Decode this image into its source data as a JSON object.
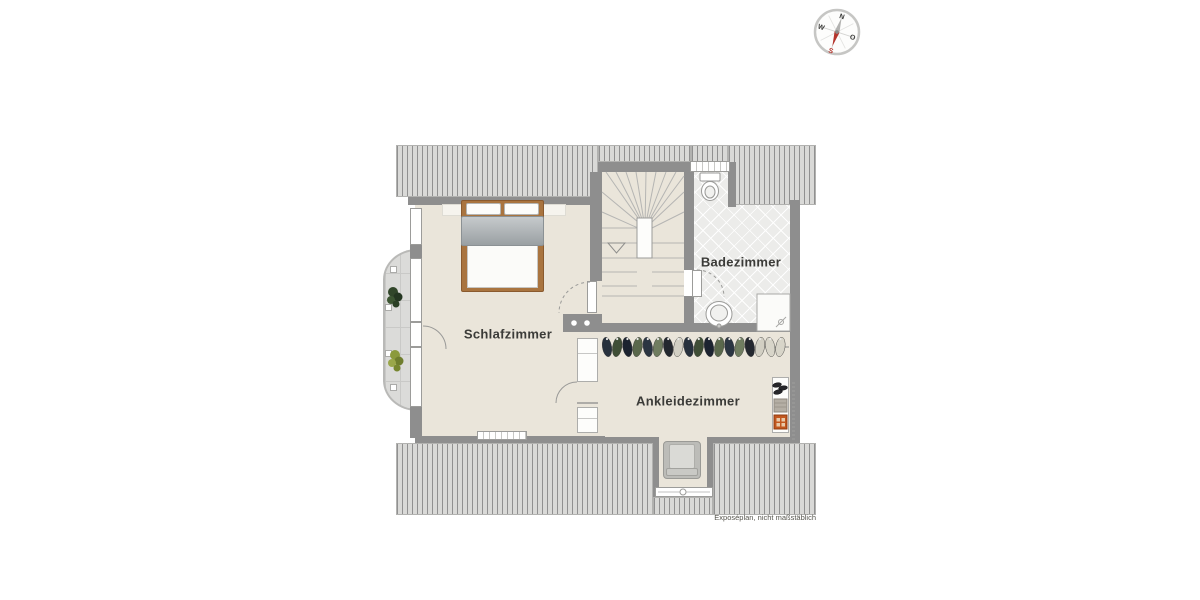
{
  "rooms": {
    "bedroom": "Schlafzimmer",
    "bathroom": "Badezimmer",
    "dressing": "Ankleidezimmer"
  },
  "caption": "Exposéplan, nicht maßstäblich",
  "compass": {
    "north": "N",
    "east": "O",
    "south": "S",
    "west": "W"
  },
  "colors": {
    "floor": "#eae5da",
    "wall": "#8e8e8e",
    "hatch_bg": "#d9d9d7",
    "hatch_line": "#909090",
    "tile": "#ececea",
    "balcony_tile": "#dbdbd9",
    "bed_wood": "#a9743f",
    "compass_south": "#b5342c",
    "clothes": [
      "#27313d",
      "#3f4e36",
      "#1c2330",
      "#5a684c",
      "#2b3542",
      "#707d60",
      "#24282f",
      "#d2cfc3"
    ]
  }
}
